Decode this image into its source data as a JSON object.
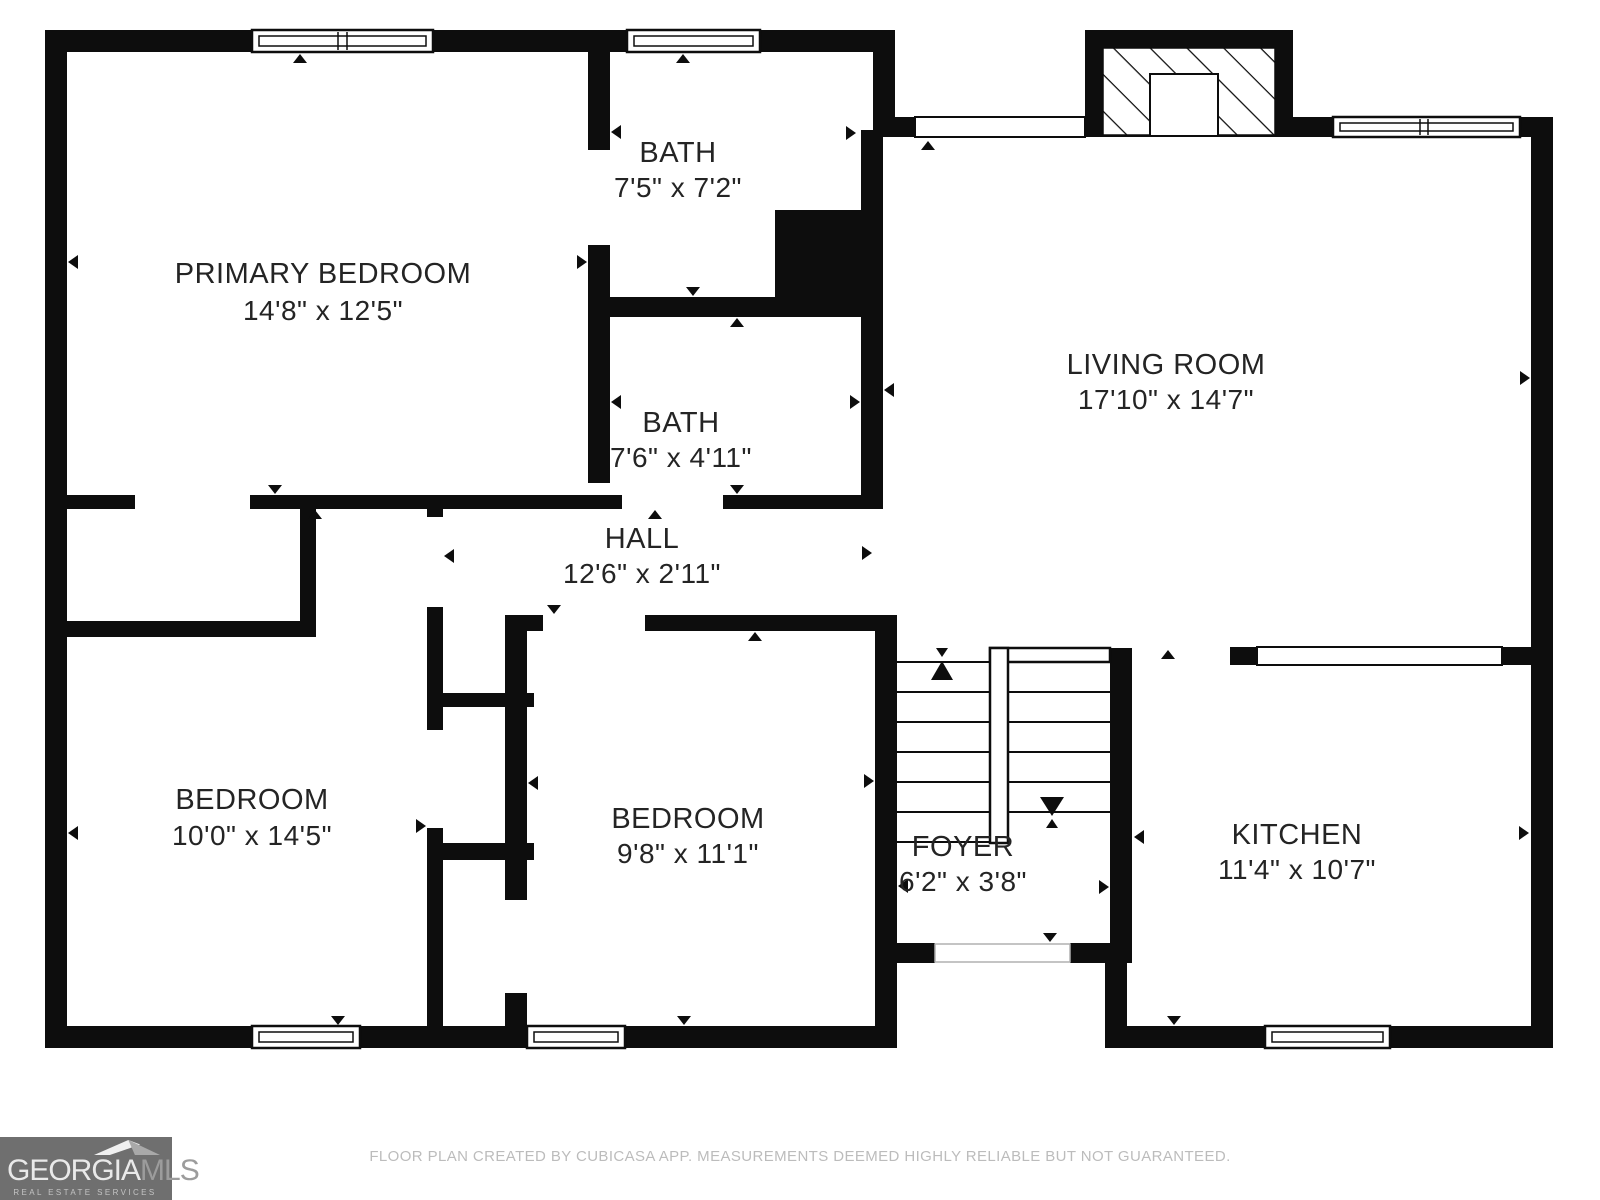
{
  "plan": {
    "rooms": [
      {
        "name": "PRIMARY BEDROOM",
        "dims": "14'8\" x 12'5\""
      },
      {
        "name": "BATH",
        "dims": "7'5\" x 7'2\""
      },
      {
        "name": "BATH",
        "dims": "7'6\" x 4'11\""
      },
      {
        "name": "HALL",
        "dims": "12'6\" x 2'11\""
      },
      {
        "name": "LIVING ROOM",
        "dims": "17'10\" x 14'7\""
      },
      {
        "name": "BEDROOM",
        "dims": "10'0\" x 14'5\""
      },
      {
        "name": "BEDROOM",
        "dims": "9'8\" x 11'1\""
      },
      {
        "name": "FOYER",
        "dims": "6'2\" x 3'8\""
      },
      {
        "name": "KITCHEN",
        "dims": "11'4\" x 10'7\""
      }
    ],
    "colors": {
      "wall": "#0d0d0d",
      "background": "#ffffff",
      "label_text": "#242424",
      "footer_text": "#bcbcbc",
      "logo_background": "#6f6f6f"
    }
  },
  "footer": {
    "disclaimer": "FLOOR PLAN CREATED BY CUBICASA APP. MEASUREMENTS DEEMED HIGHLY RELIABLE BUT NOT GUARANTEED."
  },
  "logo": {
    "brand_primary": "GEORGIA",
    "brand_secondary": "MLS",
    "tagline": "REAL ESTATE SERVICES"
  }
}
